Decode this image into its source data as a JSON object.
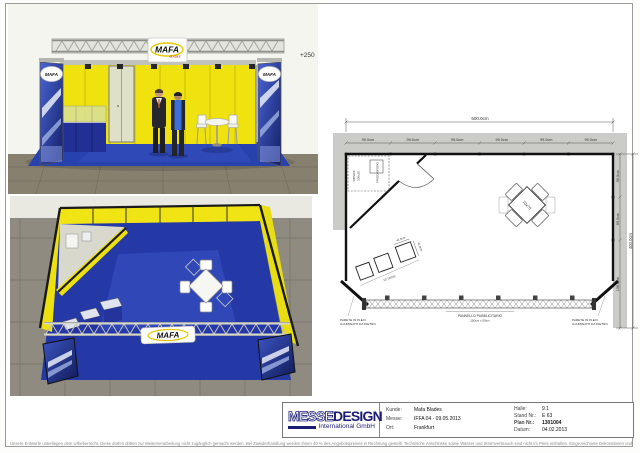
{
  "branding": {
    "logo": "MAFA",
    "logo_sub": "BLADES"
  },
  "colors": {
    "booth_yellow": "#F0E40C",
    "booth_blue": "#2438A6",
    "brand_navy": "#1C1C74"
  },
  "front_view": {
    "height_label": "+250"
  },
  "floor_plan": {
    "overall_width": "600.0cm",
    "overall_depth": "400.0cm",
    "top_segments": [
      "99.0cm",
      "99.0cm",
      "99.0cm",
      "99.0cm",
      "99.0cm",
      "99.0cm"
    ],
    "right_segments": [
      "99.0cm",
      "99.0cm",
      "198.0cm"
    ],
    "vitrine_width": "42.0cm",
    "vitrine_depth": "42.0cm",
    "table_label": "70x70",
    "shelf_line1": "RIPIANI",
    "shelf_line2": "100x30",
    "fridge_label": "FRIGORIFERO",
    "vitrine_label": "VETRINE",
    "panel_label": "PANNELLO PUBBLICITARIO",
    "panel_size": "100cm x 50cm",
    "plexi_line1": "PARETE IN PLEXI",
    "plexi_line2": "ILLUMINATO DA DIETRO"
  },
  "title_block": {
    "logo_part1": "MESSE",
    "logo_part2": "DESIGN",
    "logo_sub": "International GmbH",
    "kunde_label": "Kunde:",
    "kunde_value": "Mafa Blades",
    "messe_label": "Messe:",
    "messe_value": "IFFA  04 - 09.05.2013",
    "ort_label": "Ort:",
    "ort_value": "Frankfurt",
    "halle_label": "Halle:",
    "halle_value": "9.1",
    "stand_label": "Stand Nr.:",
    "stand_value": "E 63",
    "plan_label": "Plan Nr.:",
    "plan_value": "1301004",
    "datum_label": "Datum:",
    "datum_value": "04.02.2013"
  },
  "sheet": {
    "disclaimer": "Unsere Entwürfe unterliegen dem Urheberrecht. Diese dürfen dritten zur Weiterverarbeitung nicht zugänglich gemacht werden. Bei Zuwiderhandlung werden Ihnen 40 % des Angebotspreises in Rechnung gestellt. Technische Anschlüsse sowie Wasser und Stromverbrauch sind nicht im Preis enthalten. Eingezeichnete Dekorationen und Gegenstände die nicht in der Leistungsbeschreibung enthalten sind, gehören nicht zum Lieferumfang. Änderungen durch die Messe bleiben vorbehalten."
  }
}
